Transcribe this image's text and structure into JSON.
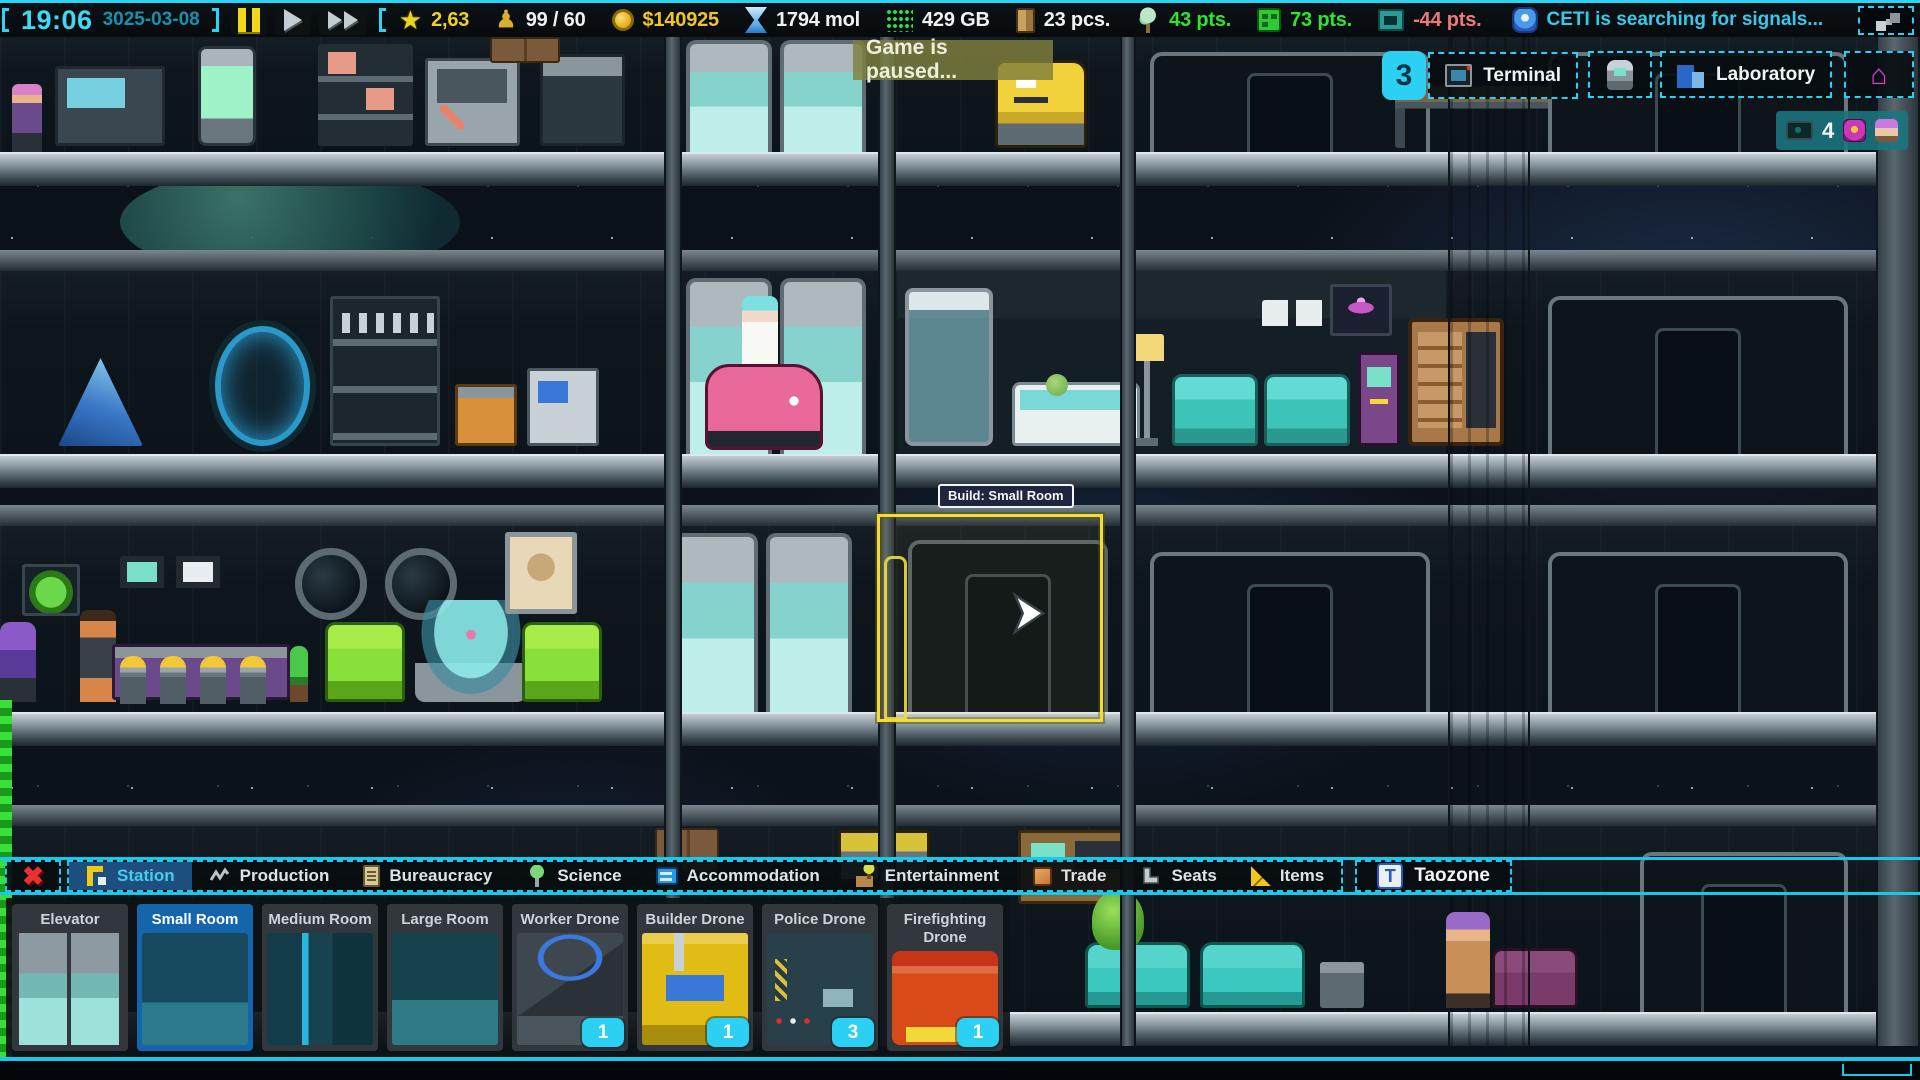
{
  "top_bar": {
    "time": "19:06",
    "date": "3025-03-08",
    "playback": {
      "pause_icon": "pause-icon",
      "play_icon": "play-icon",
      "ffwd_icon": "fast-forward-icon"
    },
    "resources": [
      {
        "name": "rating",
        "icon": "star-icon",
        "value": "2,63",
        "color": "#f0d020"
      },
      {
        "name": "population",
        "icon": "statue-icon",
        "value": "99 / 60",
        "color": "#eef2f4"
      },
      {
        "name": "money",
        "icon": "coin-icon",
        "value": "$140925",
        "color": "#f2c520"
      },
      {
        "name": "molecules",
        "icon": "hourglass-icon",
        "value": "1794 mol",
        "color": "#eef2f4"
      },
      {
        "name": "data",
        "icon": "data-matrix-icon",
        "value": "429 GB",
        "color": "#eef2f4"
      },
      {
        "name": "goods",
        "icon": "cargo-icon",
        "value": "23 pcs.",
        "color": "#eef2f4"
      },
      {
        "name": "nature",
        "icon": "tree-icon",
        "value": "43 pts.",
        "color": "#2fe42f"
      },
      {
        "name": "housing",
        "icon": "building-icon",
        "value": "73 pts.",
        "color": "#2fe42f"
      },
      {
        "name": "media",
        "icon": "screen-icon",
        "value": "-44 pts.",
        "color": "#f27878"
      }
    ],
    "status": {
      "icon": "ceti-robot-icon",
      "text": "CETI is searching for signals..."
    }
  },
  "hud": {
    "paused_banner": "Game is paused...",
    "terminal": {
      "badge": "3",
      "label": "Terminal",
      "icon": "terminal-icon"
    },
    "drone_button_icon": "drone-icon",
    "laboratory": {
      "label": "Laboratory",
      "icon": "laboratory-icon"
    },
    "house_button_icon": "house-icon",
    "viewers": {
      "icon": "camera-icon",
      "count": "4"
    },
    "build_tooltip": "Build: Small Room"
  },
  "bottom_bar": {
    "close_icon": "close-x-icon",
    "tabs": [
      {
        "label": "Station",
        "icon": "crane-icon",
        "selected": true
      },
      {
        "label": "Production",
        "icon": "conveyor-icon",
        "selected": false
      },
      {
        "label": "Bureaucracy",
        "icon": "clipboard-icon",
        "selected": false
      },
      {
        "label": "Science",
        "icon": "specimen-icon",
        "selected": false
      },
      {
        "label": "Accommodation",
        "icon": "bunk-icon",
        "selected": false
      },
      {
        "label": "Entertainment",
        "icon": "joystick-icon",
        "selected": false
      },
      {
        "label": "Trade",
        "icon": "crate-icon",
        "selected": false
      },
      {
        "label": "Seats",
        "icon": "seat-icon",
        "selected": false
      },
      {
        "label": "Items",
        "icon": "ruler-icon",
        "selected": false
      }
    ],
    "taozone": {
      "label": "Taozone",
      "icon": "taozone-icon"
    }
  },
  "palette": {
    "items": [
      {
        "label": "Elevator",
        "selected": false
      },
      {
        "label": "Small Room",
        "selected": true
      },
      {
        "label": "Medium Room",
        "selected": false
      },
      {
        "label": "Large Room",
        "selected": false
      },
      {
        "label": "Worker Drone",
        "selected": false,
        "count": "1"
      },
      {
        "label": "Builder Drone",
        "selected": false,
        "count": "1"
      },
      {
        "label": "Police Drone",
        "selected": false,
        "count": "3"
      },
      {
        "label": "Firefighting Drone",
        "selected": false,
        "count": "1"
      }
    ]
  }
}
